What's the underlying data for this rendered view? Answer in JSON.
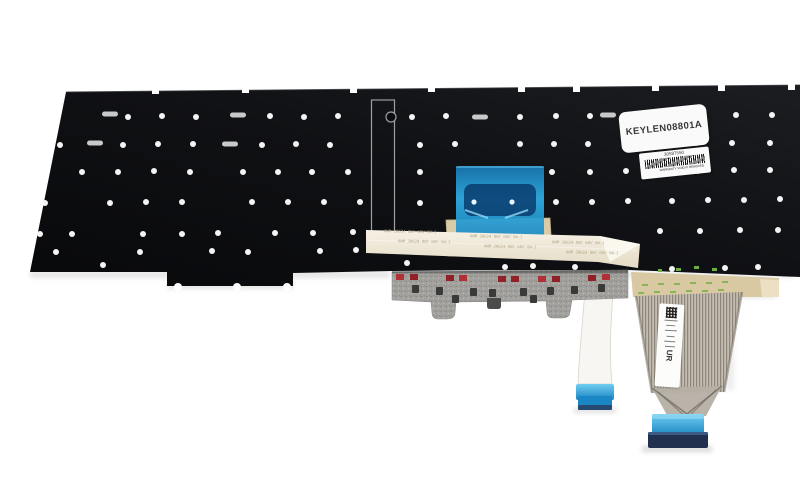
{
  "meta": {
    "description": "Rear view photo of a black laptop keyboard replacement backplate with flex cables"
  },
  "labels": {
    "part_number": "KEYLEN08801A",
    "serial_number": "30587550",
    "warranty_text": "WARRANTY VOID IF REMOVED",
    "cable_print": "AWM 20624 80C 60V VW-1",
    "ul_mark": "UR"
  },
  "colors": {
    "background": "#ffffff",
    "plate_dark": "#0b0c0e",
    "plate_light": "#1b1d21",
    "rivet": "#f4f4f4",
    "slot_silver": "#c9c9c9",
    "film_blue": "#1e9ad8",
    "film_highlight": "#8fd9f6",
    "ribbon_tan": "#f2ecdd",
    "stiffener_tan": "#d9cba6",
    "membrane_gray": "#a2a19e",
    "component_red": "#8f2127",
    "component_red_bright": "#b03038",
    "clip_dark": "#3a3a38",
    "flat_cable_tan": "#d8c9a2",
    "trace_green": "#7cb24c",
    "connector_blue": "#2b9fd8",
    "connector_navy": "#20304e",
    "cable_white": "#f7f6f2"
  },
  "plate": {
    "rivet_dots": [
      [
        128,
        117
      ],
      [
        162,
        116
      ],
      [
        196,
        117
      ],
      [
        270,
        116
      ],
      [
        304,
        117
      ],
      [
        338,
        116
      ],
      [
        412,
        117
      ],
      [
        446,
        116
      ],
      [
        520,
        117
      ],
      [
        556,
        116
      ],
      [
        590,
        116
      ],
      [
        662,
        116
      ],
      [
        700,
        116
      ],
      [
        736,
        115
      ],
      [
        772,
        115
      ],
      [
        60,
        145
      ],
      [
        123,
        145
      ],
      [
        158,
        144
      ],
      [
        193,
        144
      ],
      [
        262,
        145
      ],
      [
        296,
        144
      ],
      [
        330,
        145
      ],
      [
        420,
        145
      ],
      [
        455,
        144
      ],
      [
        520,
        144
      ],
      [
        554,
        144
      ],
      [
        588,
        144
      ],
      [
        660,
        144
      ],
      [
        696,
        143
      ],
      [
        732,
        143
      ],
      [
        770,
        143
      ],
      [
        82,
        172
      ],
      [
        118,
        172
      ],
      [
        154,
        171
      ],
      [
        190,
        172
      ],
      [
        243,
        172
      ],
      [
        278,
        172
      ],
      [
        312,
        172
      ],
      [
        348,
        172
      ],
      [
        420,
        172
      ],
      [
        552,
        172
      ],
      [
        590,
        172
      ],
      [
        626,
        171
      ],
      [
        662,
        171
      ],
      [
        698,
        171
      ],
      [
        734,
        170
      ],
      [
        770,
        170
      ],
      [
        45,
        203
      ],
      [
        110,
        203
      ],
      [
        146,
        202
      ],
      [
        182,
        202
      ],
      [
        252,
        202
      ],
      [
        288,
        202
      ],
      [
        324,
        202
      ],
      [
        360,
        202
      ],
      [
        420,
        203
      ],
      [
        556,
        202
      ],
      [
        592,
        202
      ],
      [
        628,
        201
      ],
      [
        672,
        201
      ],
      [
        708,
        200
      ],
      [
        744,
        200
      ],
      [
        780,
        199
      ],
      [
        40,
        234
      ],
      [
        72,
        234
      ],
      [
        143,
        234
      ],
      [
        182,
        234
      ],
      [
        218,
        233
      ],
      [
        275,
        233
      ],
      [
        313,
        233
      ],
      [
        353,
        232
      ],
      [
        660,
        231
      ],
      [
        700,
        231
      ],
      [
        740,
        230
      ],
      [
        778,
        230
      ],
      [
        56,
        252
      ],
      [
        103,
        265
      ],
      [
        140,
        252
      ],
      [
        212,
        251
      ],
      [
        248,
        252
      ],
      [
        320,
        251
      ],
      [
        356,
        250
      ],
      [
        407,
        263
      ],
      [
        505,
        267
      ],
      [
        533,
        266
      ],
      [
        575,
        267
      ],
      [
        672,
        269
      ],
      [
        725,
        268
      ],
      [
        758,
        267
      ]
    ],
    "screw_slots": [
      [
        110,
        114
      ],
      [
        238,
        115
      ],
      [
        480,
        117
      ],
      [
        608,
        115
      ],
      [
        95,
        143
      ],
      [
        230,
        144
      ]
    ],
    "edge_notches": [
      [
        152,
        88
      ],
      [
        242,
        87
      ],
      [
        350,
        87
      ],
      [
        428,
        86
      ],
      [
        518,
        86
      ],
      [
        573,
        86
      ],
      [
        652,
        85
      ],
      [
        718,
        85
      ],
      [
        788,
        84
      ]
    ]
  },
  "membrane": {
    "red_components": [
      [
        396,
        274
      ],
      [
        410,
        274
      ],
      [
        446,
        275
      ],
      [
        459,
        275
      ],
      [
        498,
        276
      ],
      [
        511,
        276
      ],
      [
        538,
        276
      ],
      [
        552,
        276
      ],
      [
        588,
        275
      ],
      [
        602,
        274
      ]
    ],
    "dark_clips": [
      [
        412,
        285
      ],
      [
        436,
        287
      ],
      [
        470,
        288
      ],
      [
        489,
        289
      ],
      [
        520,
        288
      ],
      [
        547,
        287
      ],
      [
        571,
        286
      ],
      [
        598,
        284
      ],
      [
        452,
        295
      ],
      [
        530,
        295
      ]
    ]
  }
}
